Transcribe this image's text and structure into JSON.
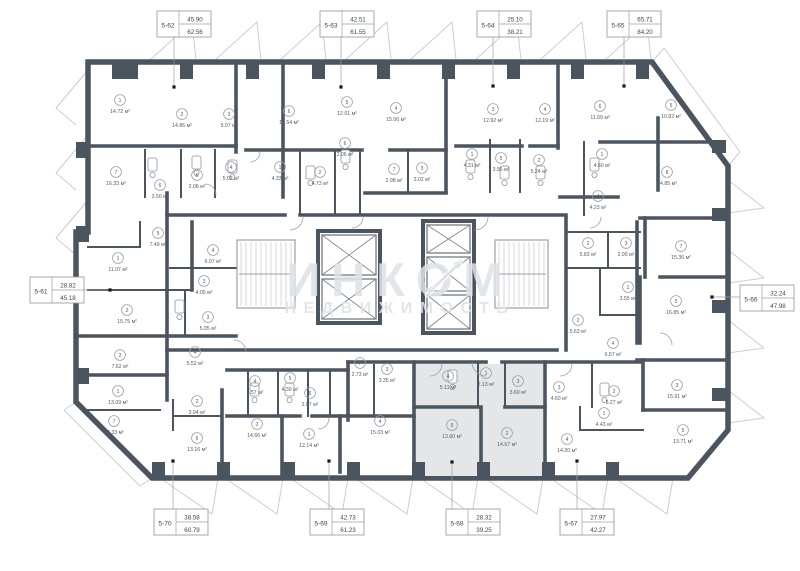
{
  "watermark": {
    "line1": "ИНКОМ",
    "line2": "НЕДВИЖИМОСТЬ"
  },
  "colors": {
    "wall": "#4b555f",
    "thin": "#9aa1a8",
    "light": "#c9ced4",
    "text": "#565c63",
    "highlight": "#e5e6e8",
    "watermark": "#dde2e8",
    "dot": "#16181a",
    "box_border": "#9aa1a8"
  },
  "units": [
    {
      "id": "5-62",
      "area_top": "45.90",
      "area_bottom": "62.56",
      "box": {
        "x": 157,
        "y": 11
      },
      "dot": {
        "x": 174,
        "y": 87
      },
      "leader": "v",
      "highlighted": false
    },
    {
      "id": "5-63",
      "area_top": "42.51",
      "area_bottom": "61.55",
      "box": {
        "x": 320,
        "y": 11
      },
      "dot": {
        "x": 341,
        "y": 87
      },
      "leader": "v",
      "highlighted": false
    },
    {
      "id": "5-64",
      "area_top": "25.10",
      "area_bottom": "38.21",
      "box": {
        "x": 477,
        "y": 11
      },
      "dot": {
        "x": 493,
        "y": 86
      },
      "leader": "v",
      "highlighted": false
    },
    {
      "id": "5-65",
      "area_top": "65.71",
      "area_bottom": "84.20",
      "box": {
        "x": 607,
        "y": 11
      },
      "dot": {
        "x": 624,
        "y": 86
      },
      "leader": "v",
      "highlighted": false
    },
    {
      "id": "5-61",
      "area_top": "28.82",
      "area_bottom": "45.18",
      "box": {
        "x": 30,
        "y": 277
      },
      "dot": {
        "x": 110,
        "y": 290
      },
      "leader": "h",
      "highlighted": false
    },
    {
      "id": "5-66",
      "area_top": "32.24",
      "area_bottom": "47.98",
      "box": {
        "x": 740,
        "y": 285
      },
      "dot": {
        "x": 712,
        "y": 297
      },
      "leader": "h",
      "highlighted": false
    },
    {
      "id": "5-70",
      "area_top": "38.58",
      "area_bottom": "60.79",
      "box": {
        "x": 154,
        "y": 509
      },
      "dot": {
        "x": 173,
        "y": 461
      },
      "leader": "v",
      "highlighted": false
    },
    {
      "id": "5-69",
      "area_top": "42.73",
      "area_bottom": "61.23",
      "box": {
        "x": 310,
        "y": 509
      },
      "dot": {
        "x": 329,
        "y": 461
      },
      "leader": "v",
      "highlighted": false
    },
    {
      "id": "5-68",
      "area_top": "28.32",
      "area_bottom": "39.25",
      "box": {
        "x": 446,
        "y": 509
      },
      "dot": {
        "x": 452,
        "y": 462
      },
      "leader": "v",
      "highlighted": true
    },
    {
      "id": "5-67",
      "area_top": "27.97",
      "area_bottom": "42.27",
      "box": {
        "x": 560,
        "y": 509
      },
      "dot": {
        "x": 577,
        "y": 461
      },
      "leader": "v",
      "highlighted": false
    }
  ],
  "rooms": [
    {
      "n": "1",
      "area": "14.72 м²",
      "x": 120,
      "y": 104
    },
    {
      "n": "2",
      "area": "14.86 м²",
      "x": 182,
      "y": 118
    },
    {
      "n": "3",
      "area": "5.07 м²",
      "x": 229,
      "y": 118
    },
    {
      "n": "7",
      "area": "16.33 м²",
      "x": 116,
      "y": 176
    },
    {
      "n": "6",
      "area": "3.50 м²",
      "x": 160,
      "y": 189
    },
    {
      "n": "5",
      "area": "2.08 м²",
      "x": 197,
      "y": 179
    },
    {
      "n": "4",
      "area": "5.02 м²",
      "x": 231,
      "y": 171
    },
    {
      "n": "6",
      "area": "14.54 м²",
      "x": 289,
      "y": 115
    },
    {
      "n": "5",
      "area": "12.01 м²",
      "x": 347,
      "y": 106
    },
    {
      "n": "1",
      "area": "4.33 м²",
      "x": 280,
      "y": 171
    },
    {
      "n": "2",
      "area": "4.73 м²",
      "x": 320,
      "y": 176
    },
    {
      "n": "6",
      "area": "2.06 м²",
      "x": 345,
      "y": 147
    },
    {
      "n": "7",
      "area": "2.98 м²",
      "x": 394,
      "y": 173
    },
    {
      "n": "3",
      "area": "3.02 м²",
      "x": 422,
      "y": 172
    },
    {
      "n": "4",
      "area": "15.06 м²",
      "x": 396,
      "y": 112
    },
    {
      "n": "3",
      "area": "12.92 м²",
      "x": 493,
      "y": 113
    },
    {
      "n": "4",
      "area": "12.19 м²",
      "x": 545,
      "y": 113
    },
    {
      "n": "6",
      "area": "11.69 м²",
      "x": 600,
      "y": 110
    },
    {
      "n": "5",
      "area": "10.82 м²",
      "x": 671,
      "y": 109
    },
    {
      "n": "1",
      "area": "4.31 м²",
      "x": 472,
      "y": 158
    },
    {
      "n": "5",
      "area": "3.56 м²",
      "x": 501,
      "y": 162
    },
    {
      "n": "2",
      "area": "5.24 м²",
      "x": 539,
      "y": 164
    },
    {
      "n": "1",
      "area": "4.60 м²",
      "x": 602,
      "y": 158
    },
    {
      "n": "8",
      "area": "24.85 м²",
      "x": 667,
      "y": 176
    },
    {
      "n": "4",
      "area": "4.23 м²",
      "x": 598,
      "y": 200
    },
    {
      "n": "2",
      "area": "5.83 м²",
      "x": 588,
      "y": 247
    },
    {
      "n": "3",
      "area": "2.99 м²",
      "x": 626,
      "y": 247
    },
    {
      "n": "7",
      "area": "15.36 м²",
      "x": 681,
      "y": 250
    },
    {
      "n": "1",
      "area": "3.55 м²",
      "x": 628,
      "y": 291
    },
    {
      "n": "5",
      "area": "16.85 м²",
      "x": 676,
      "y": 305
    },
    {
      "n": "2",
      "area": "5.63 м²",
      "x": 578,
      "y": 324
    },
    {
      "n": "4",
      "area": "6.57 м²",
      "x": 613,
      "y": 347
    },
    {
      "n": "3",
      "area": "15.91 м²",
      "x": 677,
      "y": 389
    },
    {
      "n": "5",
      "area": "13.71 м²",
      "x": 683,
      "y": 434
    },
    {
      "n": "1",
      "area": "4.43 м²",
      "x": 604,
      "y": 417
    },
    {
      "n": "3",
      "area": "4.60 м²",
      "x": 559,
      "y": 391
    },
    {
      "n": "2",
      "area": "5.27 м²",
      "x": 614,
      "y": 395
    },
    {
      "n": "4",
      "area": "14.20 м²",
      "x": 567,
      "y": 443
    },
    {
      "n": "4",
      "area": "5.11 м²",
      "x": 448,
      "y": 380
    },
    {
      "n": "1",
      "area": "2.13 м²",
      "x": 486,
      "y": 377
    },
    {
      "n": "3",
      "area": "3.60 м²",
      "x": 518,
      "y": 385
    },
    {
      "n": "5",
      "area": "13.60 м²",
      "x": 452,
      "y": 429
    },
    {
      "n": "2",
      "area": "14.67 м²",
      "x": 507,
      "y": 437
    },
    {
      "n": "7",
      "area": "2.73 м²",
      "x": 360,
      "y": 367
    },
    {
      "n": "3",
      "area": "3.35 м²",
      "x": 387,
      "y": 373
    },
    {
      "n": "4",
      "area": "15.03 м²",
      "x": 380,
      "y": 425
    },
    {
      "n": "6",
      "area": "3.97 м²",
      "x": 310,
      "y": 397
    },
    {
      "n": "1",
      "area": "12.14 м²",
      "x": 309,
      "y": 438
    },
    {
      "n": "2",
      "area": "14.66 м²",
      "x": 257,
      "y": 428
    },
    {
      "n": "4",
      "area": "4.57 м²",
      "x": 255,
      "y": 385
    },
    {
      "n": "5",
      "area": "4.39 м²",
      "x": 290,
      "y": 382
    },
    {
      "n": "2",
      "area": "15.75 м²",
      "x": 127,
      "y": 314
    },
    {
      "n": "3",
      "area": "5.05 м²",
      "x": 208,
      "y": 321
    },
    {
      "n": "2",
      "area": "7.62 м²",
      "x": 120,
      "y": 359
    },
    {
      "n": "4",
      "area": "5.52 м²",
      "x": 195,
      "y": 356
    },
    {
      "n": "1",
      "area": "13.09 м²",
      "x": 118,
      "y": 395
    },
    {
      "n": "7",
      "area": "12.33 м²",
      "x": 114,
      "y": 425
    },
    {
      "n": "2",
      "area": "3.94 м²",
      "x": 197,
      "y": 405
    },
    {
      "n": "6",
      "area": "13.16 м²",
      "x": 197,
      "y": 442
    },
    {
      "n": "1",
      "area": "11.07 м²",
      "x": 118,
      "y": 262
    },
    {
      "n": "5",
      "area": "7.49 м²",
      "x": 158,
      "y": 237
    },
    {
      "n": "4",
      "area": "6.07 м²",
      "x": 213,
      "y": 254
    },
    {
      "n": "3",
      "area": "4.05 м²",
      "x": 204,
      "y": 285
    }
  ]
}
